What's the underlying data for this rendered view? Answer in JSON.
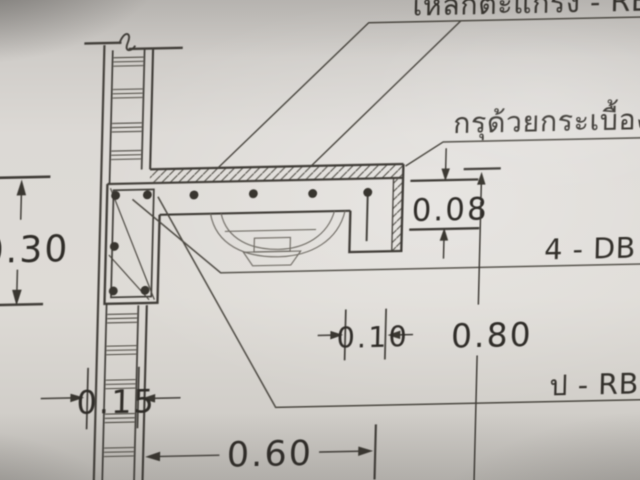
{
  "labels": {
    "mesh": "เหล็กตะแกรง - RB Ø",
    "tile": "กรุด้วยกระเบื้องเ",
    "main_bars": "4 - DB Ø",
    "stirrups": "ป - RB Ø"
  },
  "dimensions": {
    "beam_depth": "0.30",
    "slab_thickness": "0.08",
    "edge_width": "0.10",
    "height": "0.80",
    "wall_thickness": "0.15",
    "depth": "0.60"
  },
  "colors": {
    "paper": "#dcd9d5",
    "ink": "#3f3c37",
    "ink_light": "#6f6b64"
  }
}
